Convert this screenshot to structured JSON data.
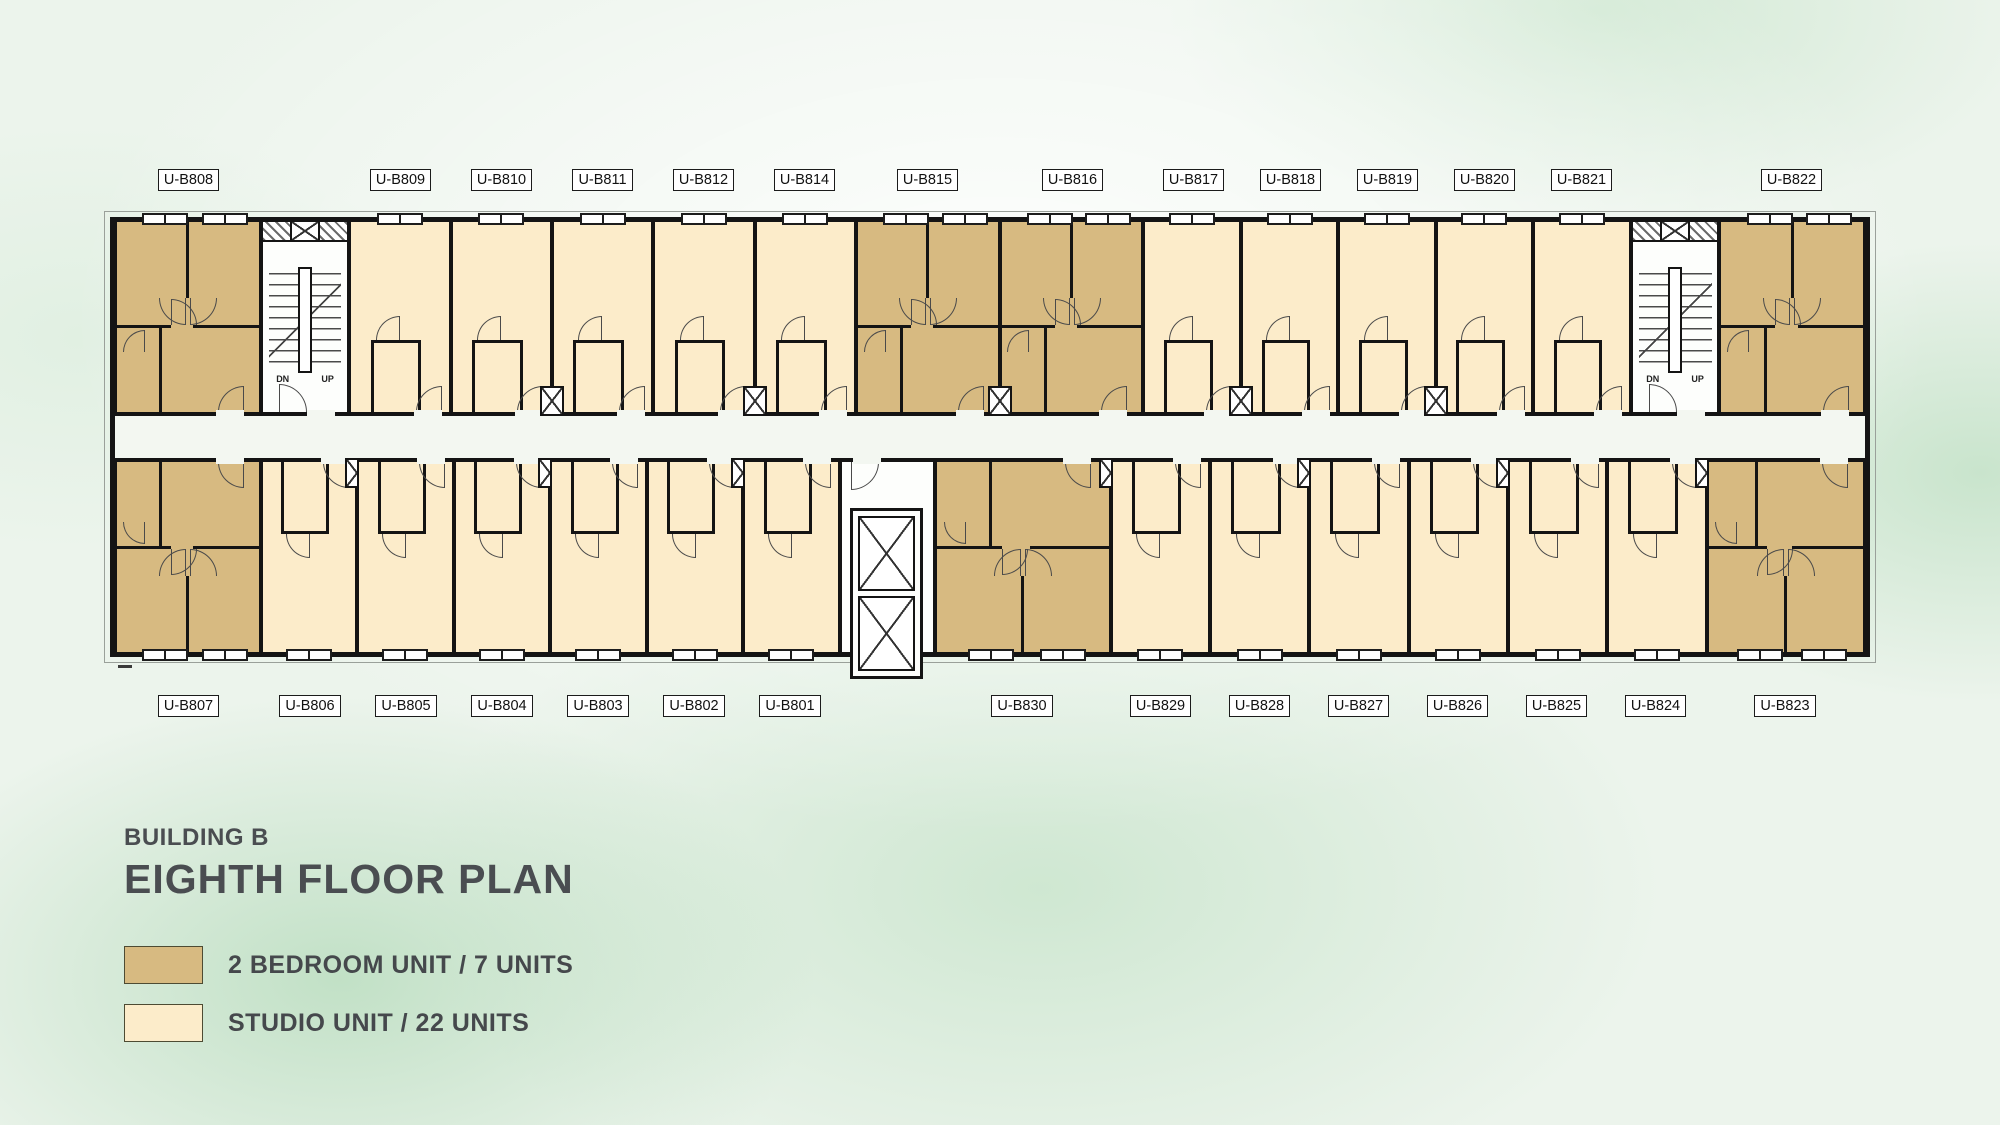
{
  "title": {
    "building": "BUILDING B",
    "floor": "EIGHTH FLOOR PLAN"
  },
  "legend": {
    "items": [
      {
        "label": "2 BEDROOM UNIT / 7 UNITS",
        "swatch_color": "#d7ba81"
      },
      {
        "label": "STUDIO UNIT / 22 UNITS",
        "swatch_color": "#fcecca"
      }
    ]
  },
  "colors": {
    "two_bedroom_fill": "#d7ba81",
    "studio_fill": "#fcecca",
    "wall": "#141414",
    "corridor_fill": "#f3f7f1",
    "background_base": "#ecf4ec",
    "title_text": "#4a4d51"
  },
  "plan": {
    "stair_dn": "DN",
    "stair_up": "UP",
    "top_units": [
      {
        "id": "U-B808",
        "type": "2br",
        "w": 147
      },
      {
        "id": "stair-west",
        "type": "stair",
        "w": 88
      },
      {
        "id": "U-B809",
        "type": "studio",
        "w": 101
      },
      {
        "id": "U-B810",
        "type": "studio",
        "w": 101,
        "shaft": true
      },
      {
        "id": "U-B811",
        "type": "studio",
        "w": 101
      },
      {
        "id": "U-B812",
        "type": "studio",
        "w": 101,
        "shaft": true
      },
      {
        "id": "U-B814",
        "type": "studio",
        "w": 101
      },
      {
        "id": "U-B815",
        "type": "2br",
        "w": 145,
        "shaft": true
      },
      {
        "id": "U-B816",
        "type": "2br",
        "w": 145
      },
      {
        "id": "U-B817",
        "type": "studio",
        "w": 97,
        "shaft": true
      },
      {
        "id": "U-B818",
        "type": "studio",
        "w": 97
      },
      {
        "id": "U-B819",
        "type": "studio",
        "w": 97,
        "shaft": true
      },
      {
        "id": "U-B820",
        "type": "studio",
        "w": 97
      },
      {
        "id": "U-B821",
        "type": "studio",
        "w": 97
      },
      {
        "id": "stair-east",
        "type": "stair",
        "w": 88
      },
      {
        "id": "U-B822",
        "type": "2br",
        "w": 147
      }
    ],
    "bottom_units": [
      {
        "id": "U-B807",
        "type": "2br",
        "w": 147
      },
      {
        "id": "U-B806",
        "type": "studio",
        "w": 96,
        "shaft": true
      },
      {
        "id": "U-B805",
        "type": "studio",
        "w": 96
      },
      {
        "id": "U-B804",
        "type": "studio",
        "w": 96,
        "shaft": true
      },
      {
        "id": "U-B803",
        "type": "studio",
        "w": 96
      },
      {
        "id": "U-B802",
        "type": "studio",
        "w": 96,
        "shaft": true
      },
      {
        "id": "U-B801",
        "type": "studio",
        "w": 96
      },
      {
        "id": "elevator-lobby",
        "type": "lobby",
        "w": 95
      },
      {
        "id": "U-B830",
        "type": "2br",
        "w": 178,
        "shaft": true
      },
      {
        "id": "U-B829",
        "type": "studio",
        "w": 99
      },
      {
        "id": "U-B828",
        "type": "studio",
        "w": 99,
        "shaft": true
      },
      {
        "id": "U-B827",
        "type": "studio",
        "w": 99
      },
      {
        "id": "U-B826",
        "type": "studio",
        "w": 99,
        "shaft": true
      },
      {
        "id": "U-B825",
        "type": "studio",
        "w": 99
      },
      {
        "id": "U-B824",
        "type": "studio",
        "w": 99,
        "shaft": true
      },
      {
        "id": "U-B823",
        "type": "2br",
        "w": 160
      }
    ]
  }
}
